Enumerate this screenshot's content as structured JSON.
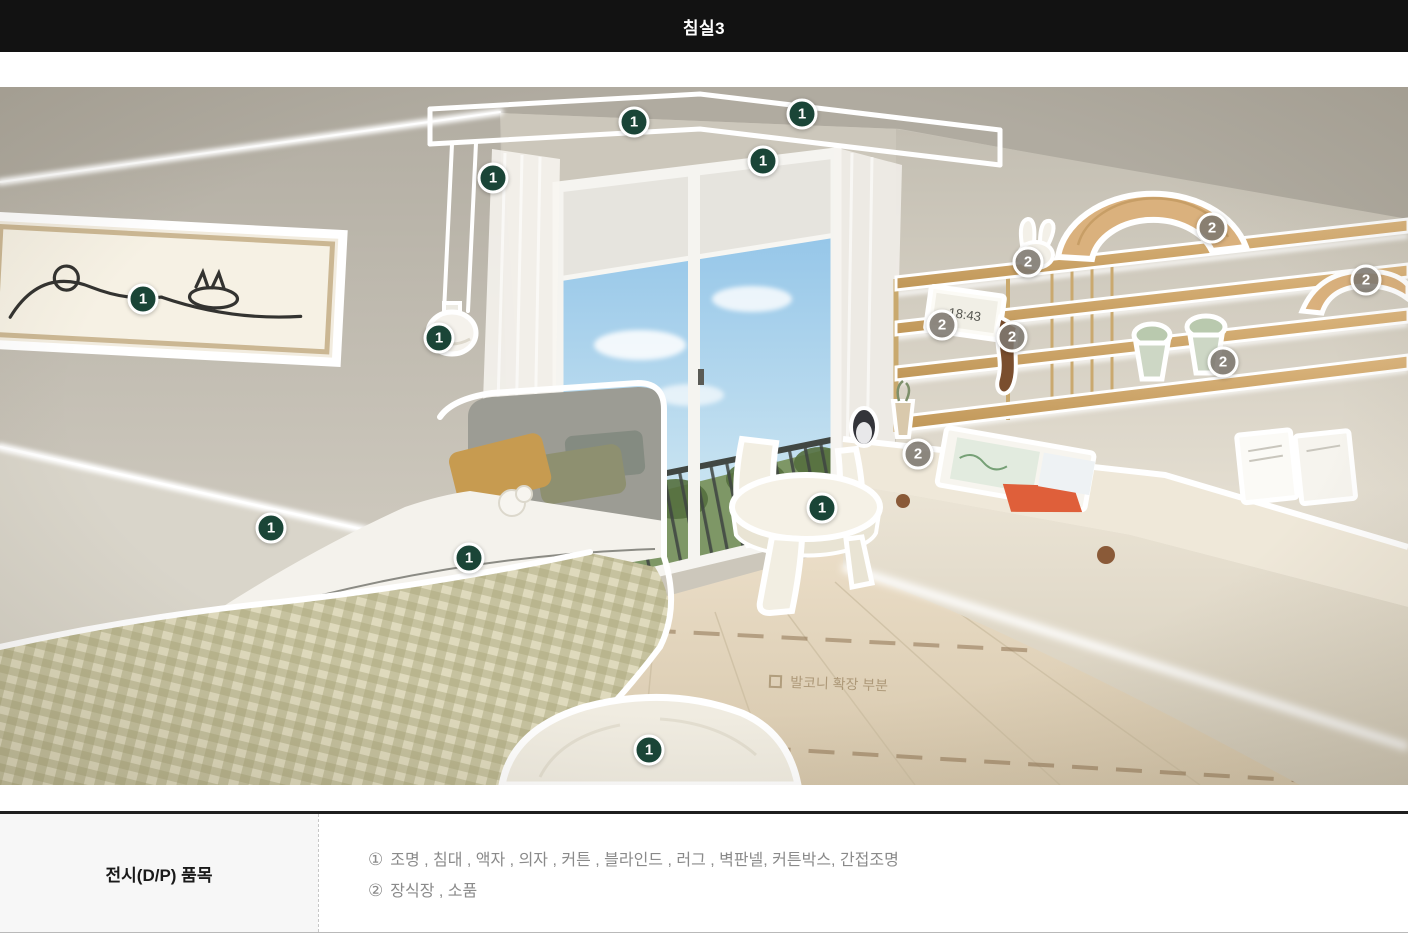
{
  "header": {
    "title": "침실3",
    "bg": "#121212",
    "text_color": "#ffffff"
  },
  "photo": {
    "floor_note": "발코니 확장 부분",
    "clock_text": "18:43",
    "marker_colors": {
      "1": "#1a4537",
      "2": "rgba(125,119,111,0.88)"
    },
    "markers": [
      {
        "label": "1",
        "x": 634,
        "y": 35
      },
      {
        "label": "1",
        "x": 802,
        "y": 27
      },
      {
        "label": "1",
        "x": 763,
        "y": 74
      },
      {
        "label": "1",
        "x": 493,
        "y": 91
      },
      {
        "label": "1",
        "x": 143,
        "y": 212
      },
      {
        "label": "1",
        "x": 439,
        "y": 251
      },
      {
        "label": "1",
        "x": 271,
        "y": 441
      },
      {
        "label": "1",
        "x": 469,
        "y": 471
      },
      {
        "label": "1",
        "x": 822,
        "y": 421
      },
      {
        "label": "1",
        "x": 649,
        "y": 663
      },
      {
        "label": "2",
        "x": 1212,
        "y": 141
      },
      {
        "label": "2",
        "x": 1028,
        "y": 175
      },
      {
        "label": "2",
        "x": 1366,
        "y": 193
      },
      {
        "label": "2",
        "x": 942,
        "y": 238
      },
      {
        "label": "2",
        "x": 1012,
        "y": 250
      },
      {
        "label": "2",
        "x": 1223,
        "y": 275
      },
      {
        "label": "2",
        "x": 918,
        "y": 367
      }
    ]
  },
  "table": {
    "row_label": "전시(D/P) 품목",
    "items": [
      {
        "prefix": "①",
        "text": "조명 , 침대 , 액자 , 의자 , 커튼 , 블라인드 , 러그 , 벽판넬, 커튼박스, 간접조명"
      },
      {
        "prefix": "②",
        "text": "장식장 , 소품"
      }
    ]
  }
}
